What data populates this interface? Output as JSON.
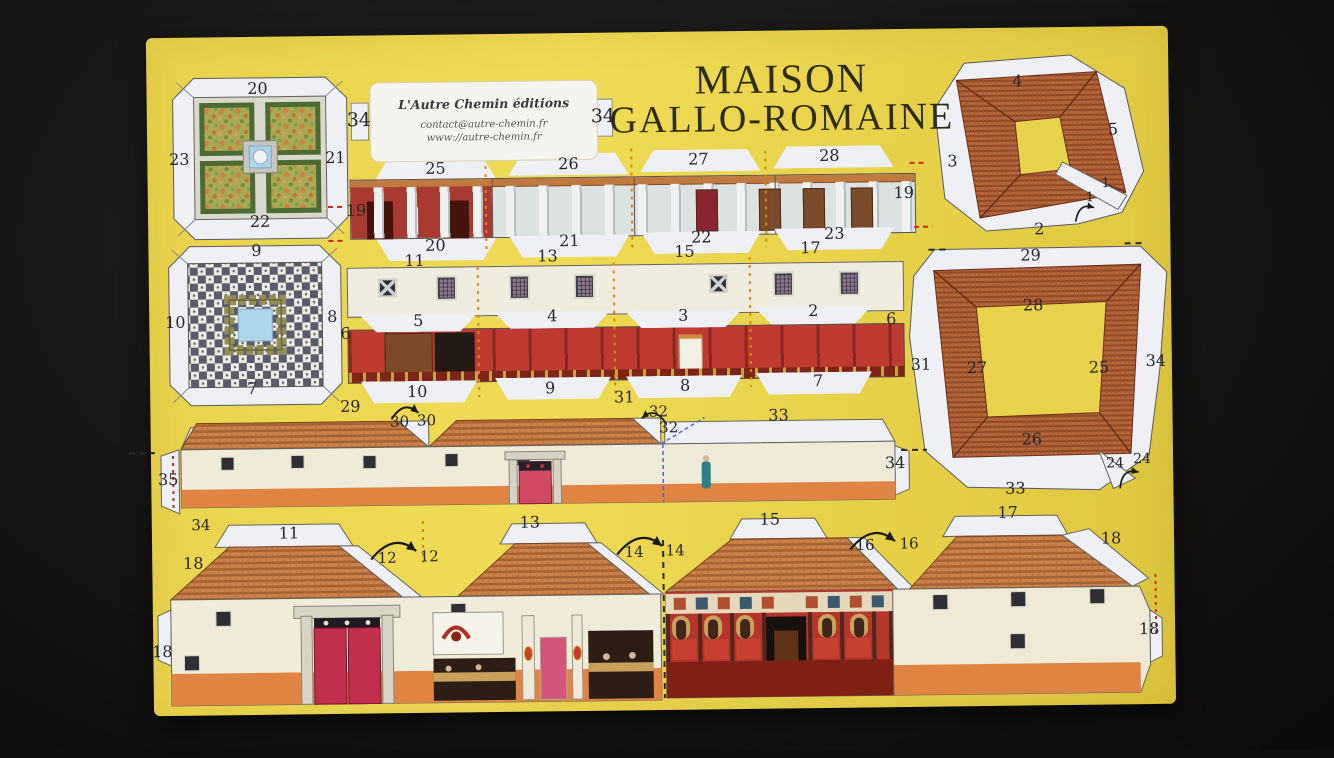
{
  "title": {
    "line1": "MAISON",
    "line2": "GALLO-ROMAINE"
  },
  "publisher": {
    "name": "L'Autre Chemin éditions",
    "contact": "contact@autre-chemin.fr",
    "website": "www://autre-chemin.fr"
  },
  "colors": {
    "sheet": "#e8d24b",
    "ink": "#26262e",
    "roof_tile": "#c27a44",
    "roof_tile_dark": "#b5663a",
    "wall_cream": "#f0ead8",
    "base_orange": "#e08444",
    "interior_red": "#bf3a30",
    "door_crimson": "#c22e4e",
    "pool_blue": "#aed6ea",
    "mosaic_dark": "#585c6f",
    "backdrop": "#151413"
  },
  "labels": [
    {
      "t": "20",
      "x": 261,
      "y": 84
    },
    {
      "t": "23",
      "x": 182,
      "y": 154
    },
    {
      "t": "21",
      "x": 338,
      "y": 154
    },
    {
      "t": "22",
      "x": 262,
      "y": 217
    },
    {
      "t": "9",
      "x": 258,
      "y": 246
    },
    {
      "t": "10",
      "x": 176,
      "y": 317
    },
    {
      "t": "8",
      "x": 333,
      "y": 313
    },
    {
      "t": "7",
      "x": 252,
      "y": 384
    },
    {
      "t": "34",
      "x": 362,
      "y": 117,
      "s": 19
    },
    {
      "t": "34",
      "x": 606,
      "y": 116,
      "s": 19
    },
    {
      "t": "25",
      "x": 438,
      "y": 166
    },
    {
      "t": "26",
      "x": 571,
      "y": 163
    },
    {
      "t": "27",
      "x": 701,
      "y": 160
    },
    {
      "t": "28",
      "x": 832,
      "y": 158
    },
    {
      "t": "19",
      "x": 358,
      "y": 207
    },
    {
      "t": "19",
      "x": 906,
      "y": 196
    },
    {
      "t": "20",
      "x": 437,
      "y": 243
    },
    {
      "t": "21",
      "x": 571,
      "y": 240
    },
    {
      "t": "22",
      "x": 703,
      "y": 238
    },
    {
      "t": "23",
      "x": 836,
      "y": 236
    },
    {
      "t": "11",
      "x": 416,
      "y": 258
    },
    {
      "t": "13",
      "x": 549,
      "y": 255
    },
    {
      "t": "15",
      "x": 686,
      "y": 252
    },
    {
      "t": "17",
      "x": 812,
      "y": 250
    },
    {
      "t": "6",
      "x": 346,
      "y": 330
    },
    {
      "t": "6",
      "x": 892,
      "y": 322
    },
    {
      "t": "5",
      "x": 419,
      "y": 318
    },
    {
      "t": "4",
      "x": 553,
      "y": 315
    },
    {
      "t": "3",
      "x": 684,
      "y": 316
    },
    {
      "t": "2",
      "x": 814,
      "y": 313
    },
    {
      "t": "10",
      "x": 417,
      "y": 389
    },
    {
      "t": "9",
      "x": 550,
      "y": 387
    },
    {
      "t": "8",
      "x": 685,
      "y": 386
    },
    {
      "t": "7",
      "x": 818,
      "y": 383
    },
    {
      "t": "29",
      "x": 350,
      "y": 403
    },
    {
      "t": "30",
      "x": 399,
      "y": 419,
      "s": 15
    },
    {
      "t": "30",
      "x": 426,
      "y": 418,
      "s": 15
    },
    {
      "t": "31",
      "x": 624,
      "y": 397
    },
    {
      "t": "32",
      "x": 658,
      "y": 412,
      "s": 15
    },
    {
      "t": "32",
      "x": 668,
      "y": 428,
      "s": 15
    },
    {
      "t": "33",
      "x": 778,
      "y": 417
    },
    {
      "t": "34",
      "x": 894,
      "y": 466
    },
    {
      "t": "35",
      "x": 167,
      "y": 474
    },
    {
      "t": "34",
      "x": 199,
      "y": 520,
      "s": 15
    },
    {
      "t": "11",
      "x": 287,
      "y": 529
    },
    {
      "t": "12",
      "x": 385,
      "y": 555,
      "s": 15
    },
    {
      "t": "12",
      "x": 427,
      "y": 554,
      "s": 15
    },
    {
      "t": "18",
      "x": 191,
      "y": 558
    },
    {
      "t": "18",
      "x": 159,
      "y": 646
    },
    {
      "t": "13",
      "x": 528,
      "y": 521
    },
    {
      "t": "14",
      "x": 632,
      "y": 552,
      "s": 15
    },
    {
      "t": "14",
      "x": 673,
      "y": 551,
      "s": 15
    },
    {
      "t": "15",
      "x": 768,
      "y": 521
    },
    {
      "t": "16",
      "x": 863,
      "y": 548,
      "s": 15
    },
    {
      "t": "16",
      "x": 907,
      "y": 547,
      "s": 15
    },
    {
      "t": "17",
      "x": 1006,
      "y": 517
    },
    {
      "t": "18",
      "x": 1109,
      "y": 544
    },
    {
      "t": "18",
      "x": 1146,
      "y": 635
    },
    {
      "t": "4",
      "x": 1021,
      "y": 86
    },
    {
      "t": "5",
      "x": 1116,
      "y": 135
    },
    {
      "t": "3",
      "x": 955,
      "y": 165
    },
    {
      "t": "2",
      "x": 1041,
      "y": 234
    },
    {
      "t": "1",
      "x": 1092,
      "y": 203,
      "s": 13
    },
    {
      "t": "1",
      "x": 1108,
      "y": 189,
      "s": 13
    },
    {
      "t": "29",
      "x": 1032,
      "y": 260
    },
    {
      "t": "28",
      "x": 1034,
      "y": 310
    },
    {
      "t": "31",
      "x": 921,
      "y": 368
    },
    {
      "t": "27",
      "x": 977,
      "y": 372
    },
    {
      "t": "25",
      "x": 1099,
      "y": 373
    },
    {
      "t": "34",
      "x": 1156,
      "y": 367
    },
    {
      "t": "26",
      "x": 1031,
      "y": 444
    },
    {
      "t": "24",
      "x": 1114,
      "y": 469,
      "s": 14
    },
    {
      "t": "24",
      "x": 1141,
      "y": 465,
      "s": 14
    },
    {
      "t": "33",
      "x": 1014,
      "y": 493
    }
  ]
}
